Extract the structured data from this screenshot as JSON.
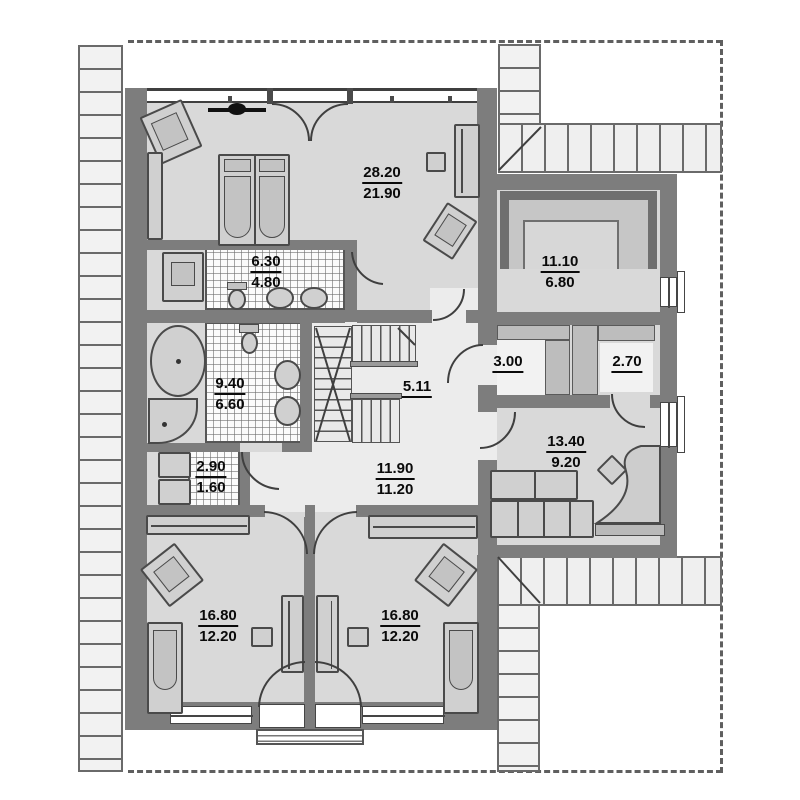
{
  "plan": {
    "type": "attic-floor-plan",
    "labels": {
      "living": {
        "area": "28.20",
        "value": "21.90"
      },
      "bath_top": {
        "area": "6.30",
        "value": "4.80"
      },
      "room_1110": {
        "area": "11.10",
        "value": "6.80"
      },
      "bath_main": {
        "area": "9.40",
        "value": "6.60"
      },
      "stair": {
        "area": "5.11"
      },
      "closet_300": {
        "area": "3.00"
      },
      "closet_270": {
        "area": "2.70"
      },
      "wc": {
        "area": "2.90",
        "value": "1.60"
      },
      "hall": {
        "area": "11.90",
        "value": "11.20"
      },
      "room_1340": {
        "area": "13.40",
        "value": "9.20"
      },
      "bedroom_left": {
        "area": "16.80",
        "value": "12.20"
      },
      "bedroom_right": {
        "area": "16.80",
        "value": "12.20"
      }
    },
    "colors": {
      "wall": "#7d7d7d",
      "room_fill": "#d9d9d9",
      "hall_fill": "#ececec",
      "roof_strip": "#efefef",
      "label_text": "#0a0a0a",
      "outline": "#4a4a4a"
    }
  }
}
